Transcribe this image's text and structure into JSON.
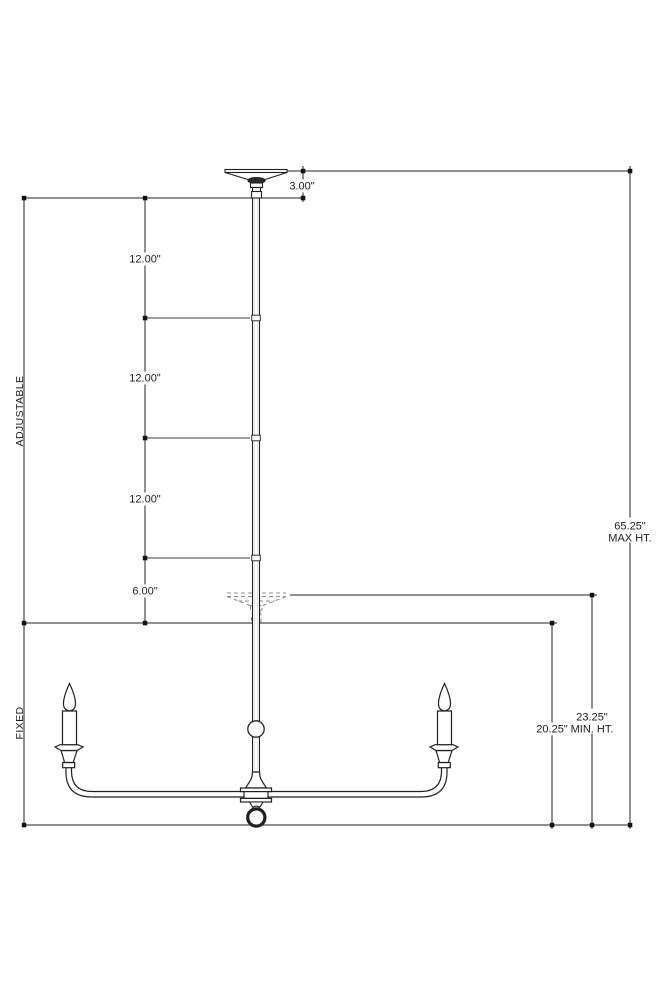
{
  "drawing": {
    "type": "lighting-fixture-dimension-diagram",
    "side_labels": {
      "adjustable": "ADJUSTABLE",
      "fixed": "FIXED"
    },
    "dimensions": {
      "canopy_height": "3.00\"",
      "rod_segment_1": "12.00\"",
      "rod_segment_2": "12.00\"",
      "rod_segment_3": "12.00\"",
      "rod_stub": "6.00\"",
      "max_height_value": "65.25\"",
      "max_height_label": "MAX HT.",
      "min_height_value": "23.25\"",
      "min_height_label": "MIN. HT.",
      "fixture_height": "20.25\""
    },
    "colors": {
      "line": "#231f20",
      "tick_gray": "#9e9e9e",
      "phantom_gray": "#8f8f8f",
      "background": "#ffffff"
    }
  }
}
